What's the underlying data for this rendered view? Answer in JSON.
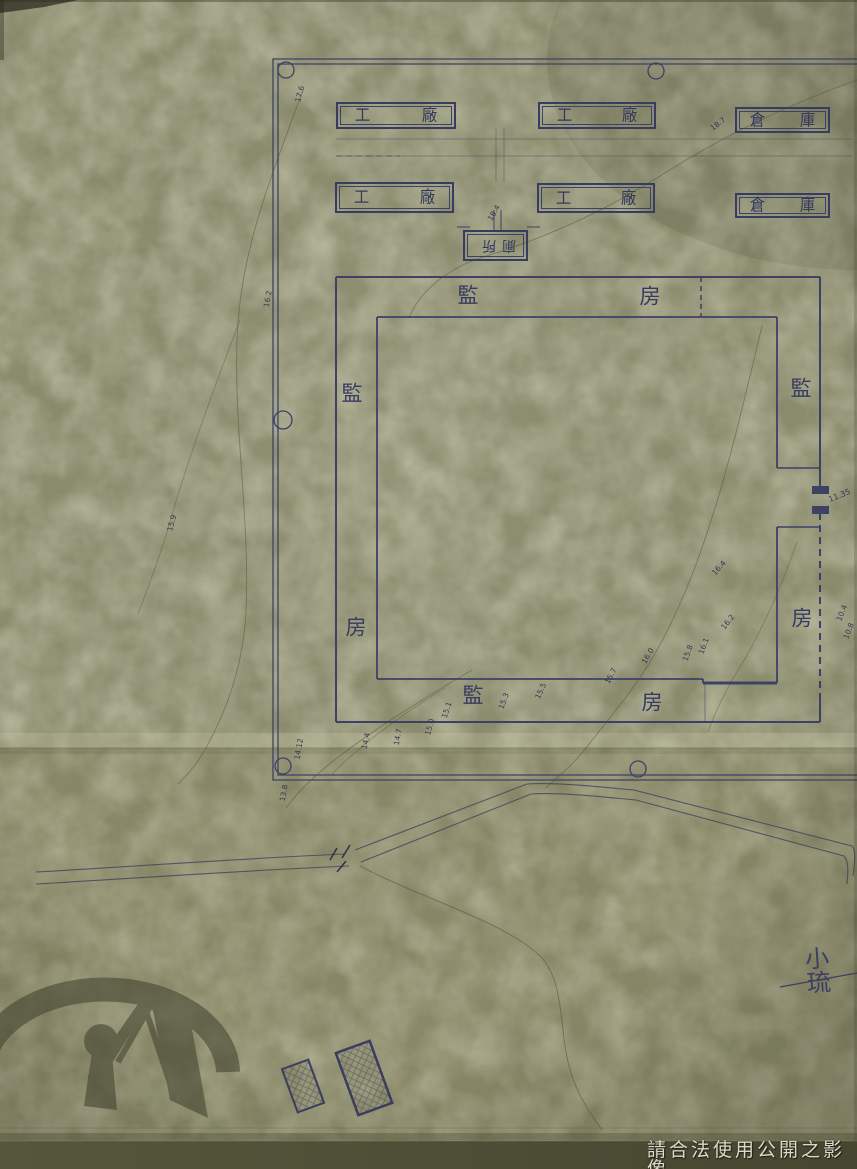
{
  "plan": {
    "factories_row1": [
      {
        "c1": "工",
        "c2": "廠"
      },
      {
        "c1": "工",
        "c2": "廠"
      },
      {
        "c1": "倉",
        "c2": "庫"
      }
    ],
    "factories_row2": [
      {
        "c1": "工",
        "c2": "廠"
      },
      {
        "c1": "工",
        "c2": "廠"
      },
      {
        "c1": "倉",
        "c2": "庫"
      }
    ],
    "toilet_label": "廁所",
    "cell_block": {
      "top": [
        "監",
        "房"
      ],
      "left": [
        "監",
        "房"
      ],
      "right": [
        "監",
        "房"
      ],
      "bottom": [
        "監",
        "房"
      ]
    },
    "gate_dimension": "11.35",
    "place_label": "小琉"
  },
  "contour_labels": [
    {
      "v": "17.6",
      "x": 300,
      "y": 94,
      "r": -75
    },
    {
      "v": "16.2",
      "x": 268,
      "y": 299,
      "r": -80
    },
    {
      "v": "15.9",
      "x": 172,
      "y": 523,
      "r": -75
    },
    {
      "v": "18.7",
      "x": 718,
      "y": 124,
      "r": -38
    },
    {
      "v": "18.4",
      "x": 494,
      "y": 213,
      "r": -60
    },
    {
      "v": "14.12",
      "x": 299,
      "y": 749,
      "r": -80
    },
    {
      "v": "13.8",
      "x": 284,
      "y": 793,
      "r": -80
    },
    {
      "v": "14.4",
      "x": 366,
      "y": 741,
      "r": -78
    },
    {
      "v": "14.7",
      "x": 398,
      "y": 737,
      "r": -80
    },
    {
      "v": "15.0",
      "x": 430,
      "y": 727,
      "r": -75
    },
    {
      "v": "15.1",
      "x": 447,
      "y": 710,
      "r": -72
    },
    {
      "v": "15.3",
      "x": 504,
      "y": 701,
      "r": -70
    },
    {
      "v": "15.5",
      "x": 541,
      "y": 691,
      "r": -66
    },
    {
      "v": "15.7",
      "x": 611,
      "y": 676,
      "r": -62
    },
    {
      "v": "16.0",
      "x": 648,
      "y": 656,
      "r": -60
    },
    {
      "v": "15.8",
      "x": 688,
      "y": 653,
      "r": -70
    },
    {
      "v": "16.1",
      "x": 704,
      "y": 646,
      "r": -70
    },
    {
      "v": "16.4",
      "x": 719,
      "y": 568,
      "r": -48
    },
    {
      "v": "16.2",
      "x": 728,
      "y": 622,
      "r": -52
    },
    {
      "v": "10.4",
      "x": 842,
      "y": 613,
      "r": -68
    },
    {
      "v": "10.8",
      "x": 849,
      "y": 631,
      "r": -68
    }
  ],
  "watermarks": {
    "bottom_right_text": "請合法使用公開之影像",
    "archives_logo_icon": "archives-logo"
  },
  "colors": {
    "ink": "#3d4166",
    "paper": "#8f906f",
    "pencil": "#52542f",
    "bottom_strip": "#55563b",
    "watermark_text": "#dadac7"
  }
}
